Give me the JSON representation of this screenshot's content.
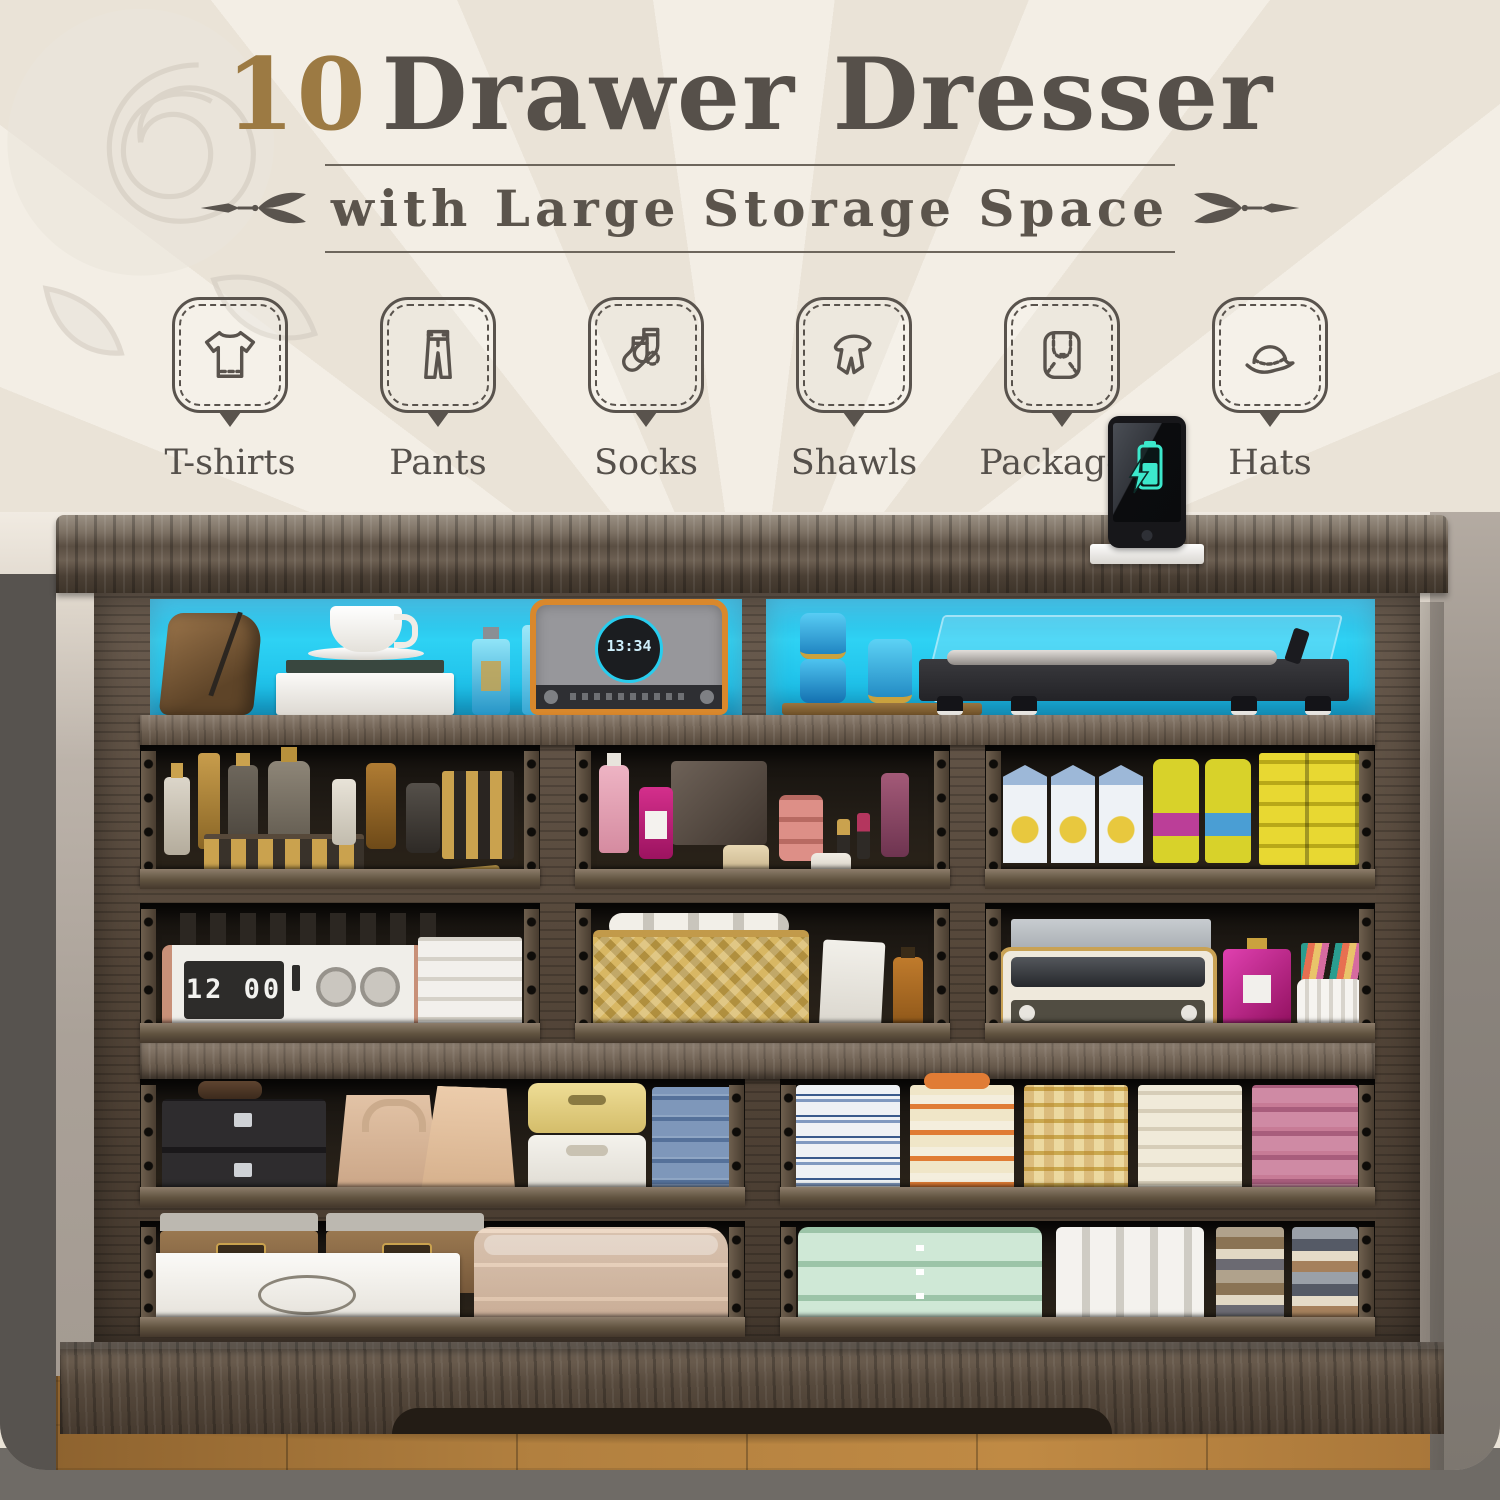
{
  "header": {
    "title_number": "10",
    "title_text": "Drawer Dresser",
    "subtitle": "with Large Storage Space",
    "title_number_color": "#9c7a43",
    "title_color": "#56504a"
  },
  "features": [
    {
      "id": "tshirts",
      "label": "T-shirts"
    },
    {
      "id": "pants",
      "label": "Pants"
    },
    {
      "id": "socks",
      "label": "Socks"
    },
    {
      "id": "shawls",
      "label": "Shawls"
    },
    {
      "id": "packages",
      "label": "Packages"
    },
    {
      "id": "hats",
      "label": "Hats"
    }
  ],
  "phone": {
    "status": "charging",
    "battery_color": "#3ce8cc"
  },
  "dresser": {
    "drawer_count": 10,
    "led_color": "#1fc2ea",
    "wood_color": "#5c4f43",
    "flip_clock_display": "12 00",
    "radio_display": "13:34",
    "top_shelf": {
      "left_contents": "Leather bag, tea cup and saucer on books, blue perfume bottles, retro radio with clock dial",
      "right_contents": "Blue glass jars on wooden tray, record player with clear dust cover"
    },
    "drawers": [
      {
        "row": 1,
        "position": "left",
        "contents": "Perfume and cosmetic bottles in gold, amber and grey, vial rack"
      },
      {
        "row": 1,
        "position": "middle",
        "contents": "Pink and magenta cosmetics, blush jars, lipsticks, mirror palette"
      },
      {
        "row": 1,
        "position": "right",
        "contents": "White cartons, yellow canisters, stacked yellow boxes"
      },
      {
        "row": 2,
        "position": "left",
        "contents": "Flip clock radio, stacked white books, dark bottles behind"
      },
      {
        "row": 2,
        "position": "middle",
        "contents": "Rattan basket with rolled towels, white boxes, amber bottle"
      },
      {
        "row": 2,
        "position": "right",
        "contents": "Vintage radio, letter tray, magenta perfume bottles, pen cup with pens"
      },
      {
        "row": 3,
        "position": "left",
        "contents": "Black jewellery boxes, beige handbags, yellow and white bins, folded jeans, grey knits"
      },
      {
        "row": 3,
        "position": "right",
        "contents": "Folded shirt stacks in blue-white, orange, yellow plaid, cream and pink"
      },
      {
        "row": 4,
        "position": "left",
        "contents": "Brown fabric storage boxes, white gift box, folded beige blanket"
      },
      {
        "row": 4,
        "position": "right",
        "contents": "Mint knit sweaters, white folded garments, mixed folded clothes stacks"
      }
    ]
  }
}
